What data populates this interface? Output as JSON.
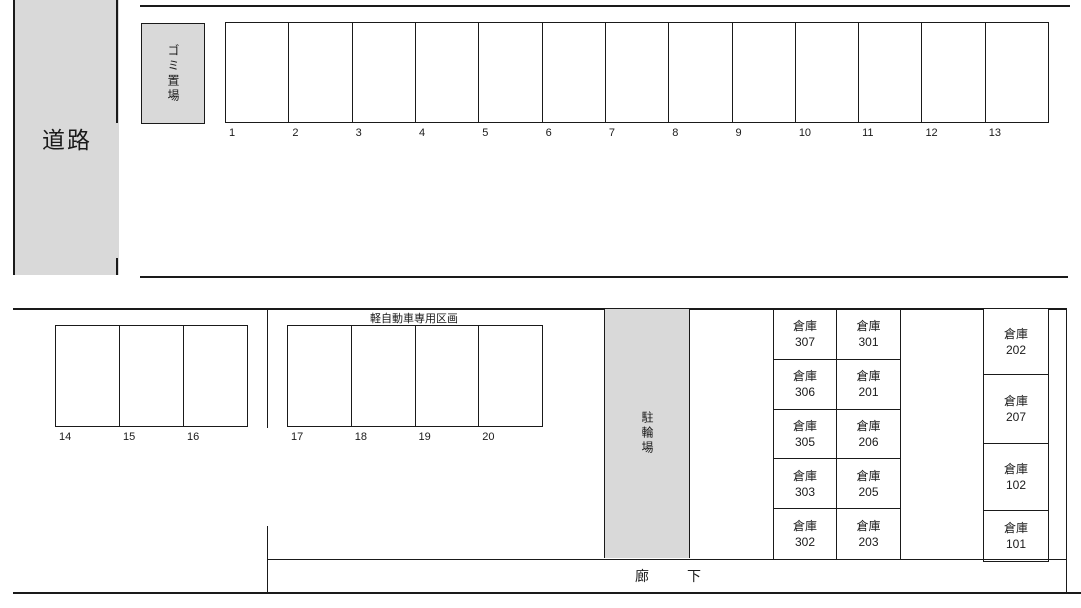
{
  "labels": {
    "road": "道路",
    "garbage_storage": "ゴミ置場",
    "bicycle_parking": "駐輪場",
    "corridor": "廊下",
    "kei_car_section": "軽自動車専用区画",
    "warehouse_prefix": "倉庫"
  },
  "parking": {
    "row_top": [
      "1",
      "2",
      "3",
      "4",
      "5",
      "6",
      "7",
      "8",
      "9",
      "10",
      "11",
      "12",
      "13"
    ],
    "row_left": [
      "14",
      "15",
      "16"
    ],
    "row_kei": [
      "17",
      "18",
      "19",
      "20"
    ]
  },
  "warehouses": {
    "block_left_rows": [
      [
        "307",
        "301"
      ],
      [
        "306",
        "201"
      ],
      [
        "305",
        "206"
      ],
      [
        "303",
        "205"
      ],
      [
        "302",
        "203"
      ]
    ],
    "block_right": [
      "202",
      "207",
      "102",
      "101"
    ]
  },
  "colors": {
    "area_fill": "#d9d9d9",
    "line": "#1a1a1a"
  }
}
